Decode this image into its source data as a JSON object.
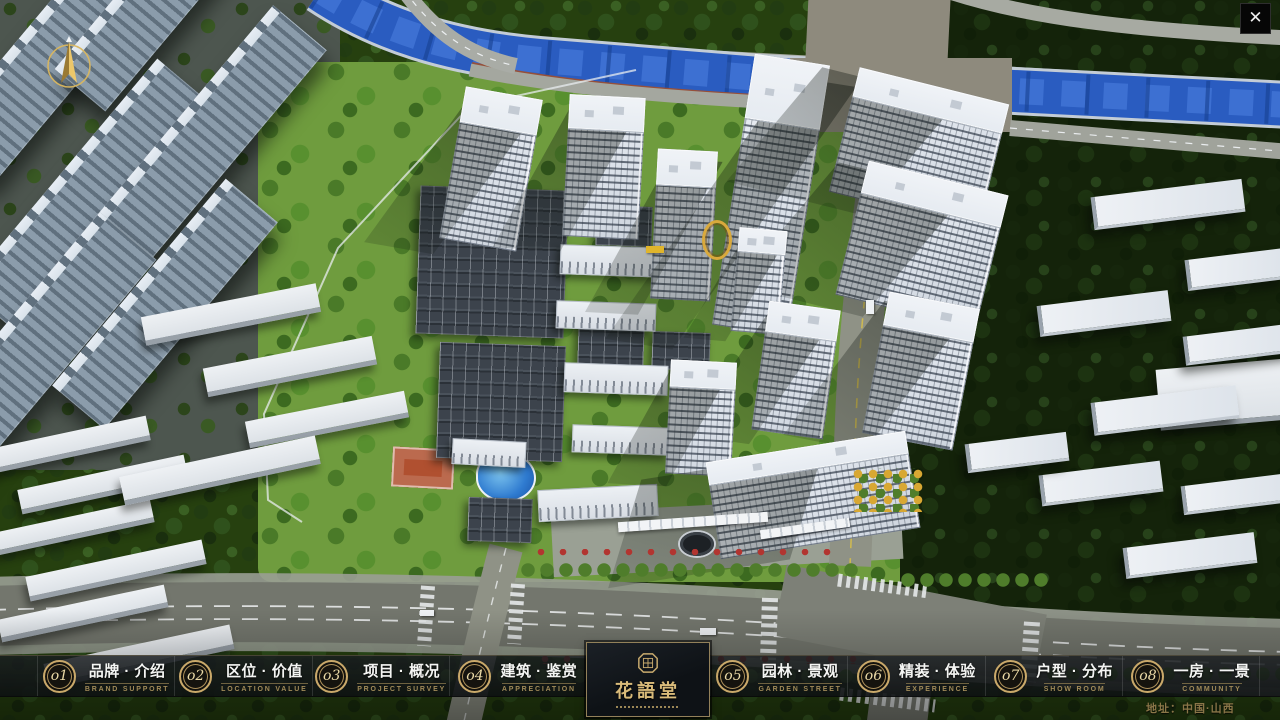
{
  "ui": {
    "close_icon": "✕",
    "address": "地址：中国·山西"
  },
  "nav": {
    "logo": {
      "title": "花語堂"
    },
    "items": [
      {
        "num": "o1",
        "zh": "品牌 · 介绍",
        "en": "BRAND SUPPORT"
      },
      {
        "num": "o2",
        "zh": "区位 · 价值",
        "en": "LOCATION VALUE"
      },
      {
        "num": "o3",
        "zh": "项目 · 概况",
        "en": "PROJECT SURVEY"
      },
      {
        "num": "o4",
        "zh": "建筑 · 鉴赏",
        "en": "APPRECIATION"
      },
      {
        "num": "o5",
        "zh": "园林 · 景观",
        "en": "GARDEN STREET"
      },
      {
        "num": "o6",
        "zh": "精装 · 体验",
        "en": "EXPERIENCE"
      },
      {
        "num": "o7",
        "zh": "户型 · 分布",
        "en": "SHOW ROOM"
      },
      {
        "num": "o8",
        "zh": "一房 · 一景",
        "en": "COMMUNITY"
      }
    ]
  }
}
